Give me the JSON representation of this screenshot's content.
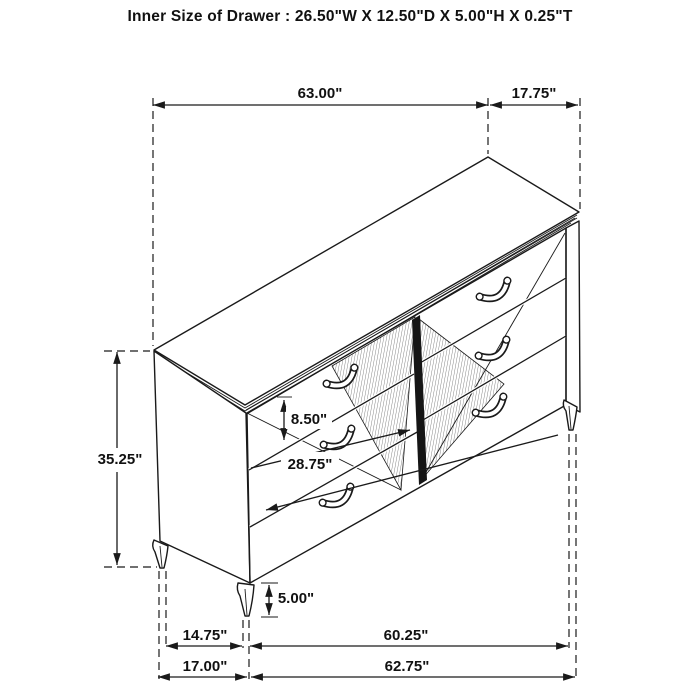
{
  "title": "Inner Size of Drawer : 26.50\"W X 12.50\"D X 5.00\"H X 0.25\"T",
  "dimensions": {
    "top_width": "63.00\"",
    "top_depth": "17.75\"",
    "overall_height": "35.25\"",
    "drawer_front_height": "8.50\"",
    "drawer_front_width": "28.75\"",
    "leg_height": "5.00\"",
    "base_side_depth_inner": "14.75\"",
    "base_front_width_inner": "60.25\"",
    "base_side_depth_outer": "17.00\"",
    "base_front_width_outer": "62.75\""
  },
  "style": {
    "line_color": "#1a1a1a",
    "background": "#ffffff"
  }
}
